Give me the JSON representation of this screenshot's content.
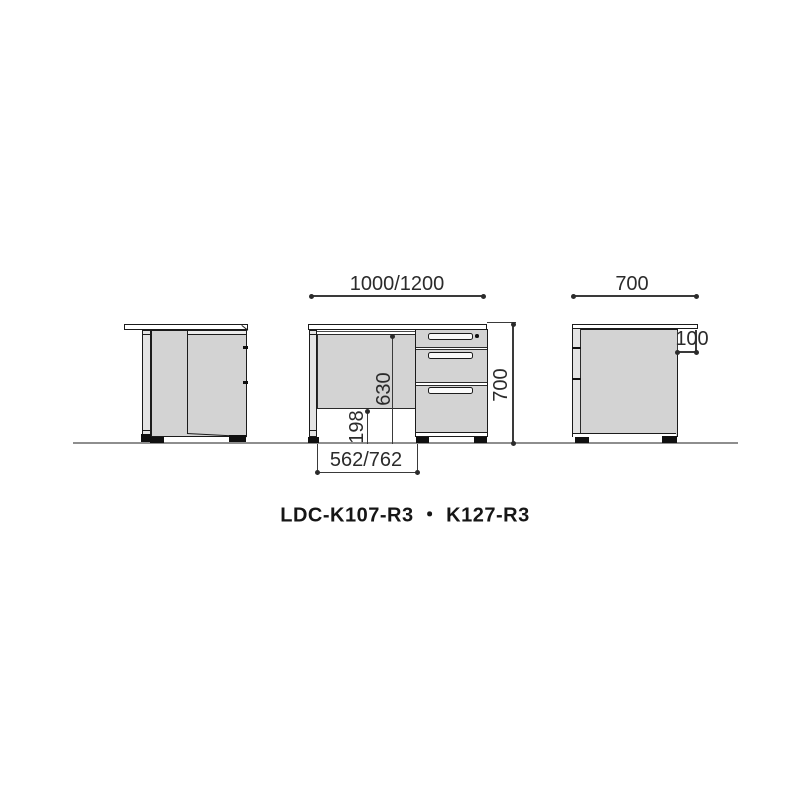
{
  "title": {
    "text": "LDC-K107-R3 ・ K127-R3"
  },
  "dimensions": {
    "front_width": "1000/1200",
    "side_depth": "700",
    "overall_height": "700",
    "knee_clearance_height": "630",
    "panel_floor_clearance": "198",
    "knee_space_width": "562/762",
    "top_rear_overhang": "100"
  },
  "colors": {
    "background": "#ffffff",
    "panel_fill": "#d3d3d3",
    "outline": "#1b1b1b",
    "dimension_line": "#3a3a3a",
    "ground_line": "#8e8e8e"
  }
}
